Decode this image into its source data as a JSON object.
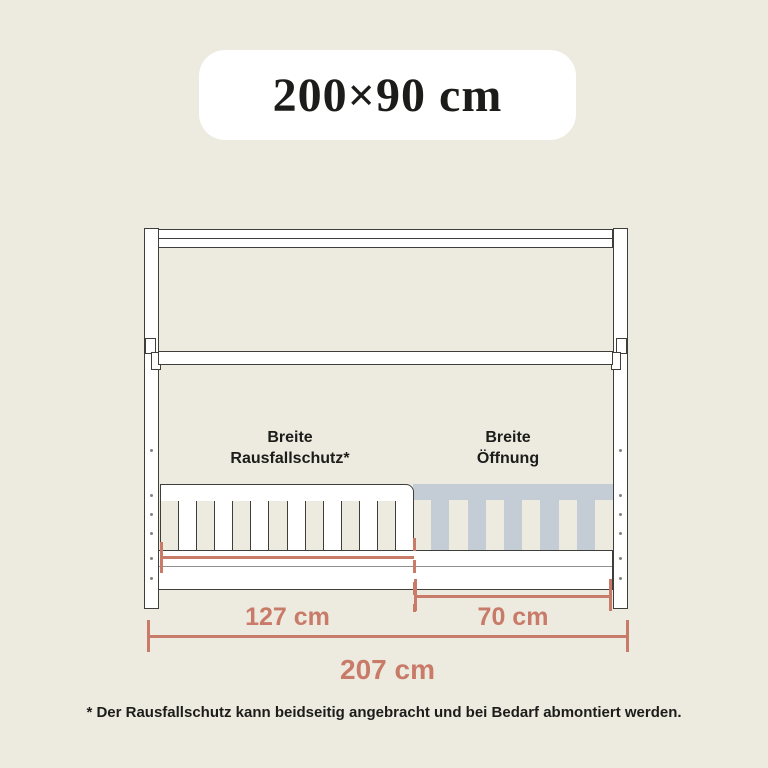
{
  "badge": {
    "size_label": "200×90 cm"
  },
  "diagram": {
    "labels": {
      "rail_line1": "Breite",
      "rail_line2": "Rausfallschutz*",
      "opening_line1": "Breite",
      "opening_line2": "Öffnung"
    },
    "dimensions": {
      "rail_width": "127 cm",
      "opening_width": "70 cm",
      "total_width": "207 cm"
    },
    "structure": {
      "white_slat_panels": 14,
      "ghost_slat_panels": 11
    },
    "colors": {
      "background": "#EDEADF",
      "outline": "#3E3E3B",
      "ghost_rail": "#C4CDD5",
      "dimension_accent": "#C97B69",
      "text": "#1C1C1A"
    }
  },
  "footnote": "* Der Rausfallschutz kann beidseitig angebracht und bei Bedarf abmontiert werden."
}
